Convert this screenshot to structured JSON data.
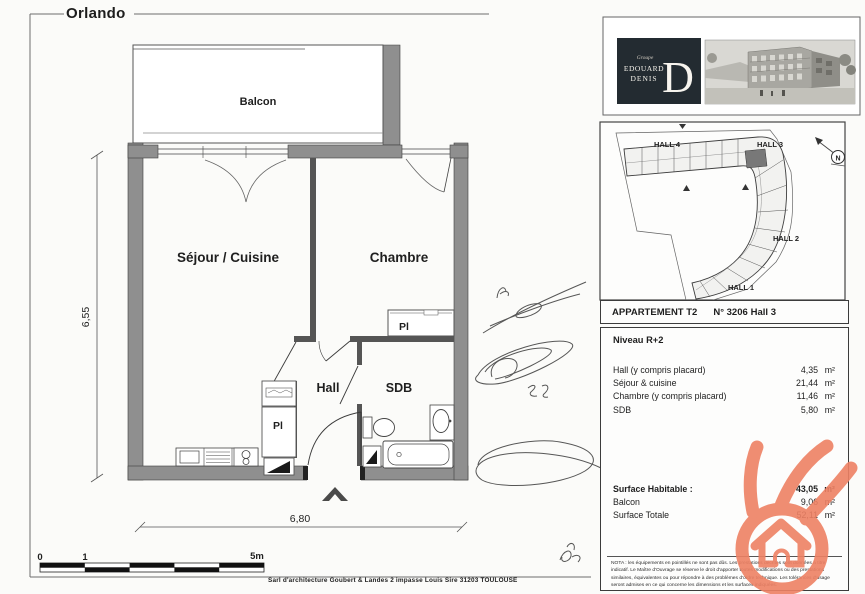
{
  "page": {
    "title": "Orlando",
    "footer": "Sarl d'architecture Goubert & Landes 2 impasse Louis Sire 31203 TOULOUSE"
  },
  "plan": {
    "labels": {
      "balcony": "Balcon",
      "living": "Séjour / Cuisine",
      "bedroom": "Chambre",
      "hall": "Hall",
      "bathroom": "SDB",
      "closet_hall": "Pl",
      "closet_bedroom": "Pl"
    },
    "dims": {
      "height": "6,55",
      "width": "6,80"
    },
    "scale": {
      "zero": "0",
      "one": "1",
      "five": "5m"
    }
  },
  "site": {
    "halls": [
      "HALL 4",
      "HALL 3",
      "HALL 2",
      "HALL 1"
    ],
    "north": "N"
  },
  "logo": {
    "group": "Groupe",
    "line1": "EDOUARD",
    "line2": "DENIS",
    "initial": "D"
  },
  "info": {
    "header": {
      "type": "APPARTEMENT T2",
      "number": "N° 3206",
      "hall": "Hall 3"
    },
    "level": "Niveau R+2",
    "unit": "m²",
    "rooms": [
      {
        "label": "Hall (y compris placard)",
        "value": "4,35"
      },
      {
        "label": "Séjour & cuisine",
        "value": "21,44"
      },
      {
        "label": "Chambre (y compris placard)",
        "value": "11,46"
      },
      {
        "label": "SDB",
        "value": "5,80"
      }
    ],
    "totals": [
      {
        "label": "Surface Habitable :",
        "value": "43,05"
      },
      {
        "label": "Balcon",
        "value": "9,06"
      },
      {
        "label": "Surface Totale",
        "value": "52,11"
      }
    ],
    "nota": "NOTA : les équipements en pointillés ne sont pas dûs. Les prestations décrites sont données à titre indicatif. Le Maître d'Ouvrage se réserve le droit d'apporter toutes modifications ou des prestations similaires, équivalentes ou pour répondre à des problèmes d'ordre technique. Les tolérances d'usage seront admises en ce qui concerne les dimensions et les surfaces indiquées."
  },
  "colors": {
    "wall": "#8f8f8f",
    "wall_dark": "#555555",
    "line": "#2e2e2e",
    "watermark": "#ee8164",
    "logo_bg": "#232b31"
  }
}
